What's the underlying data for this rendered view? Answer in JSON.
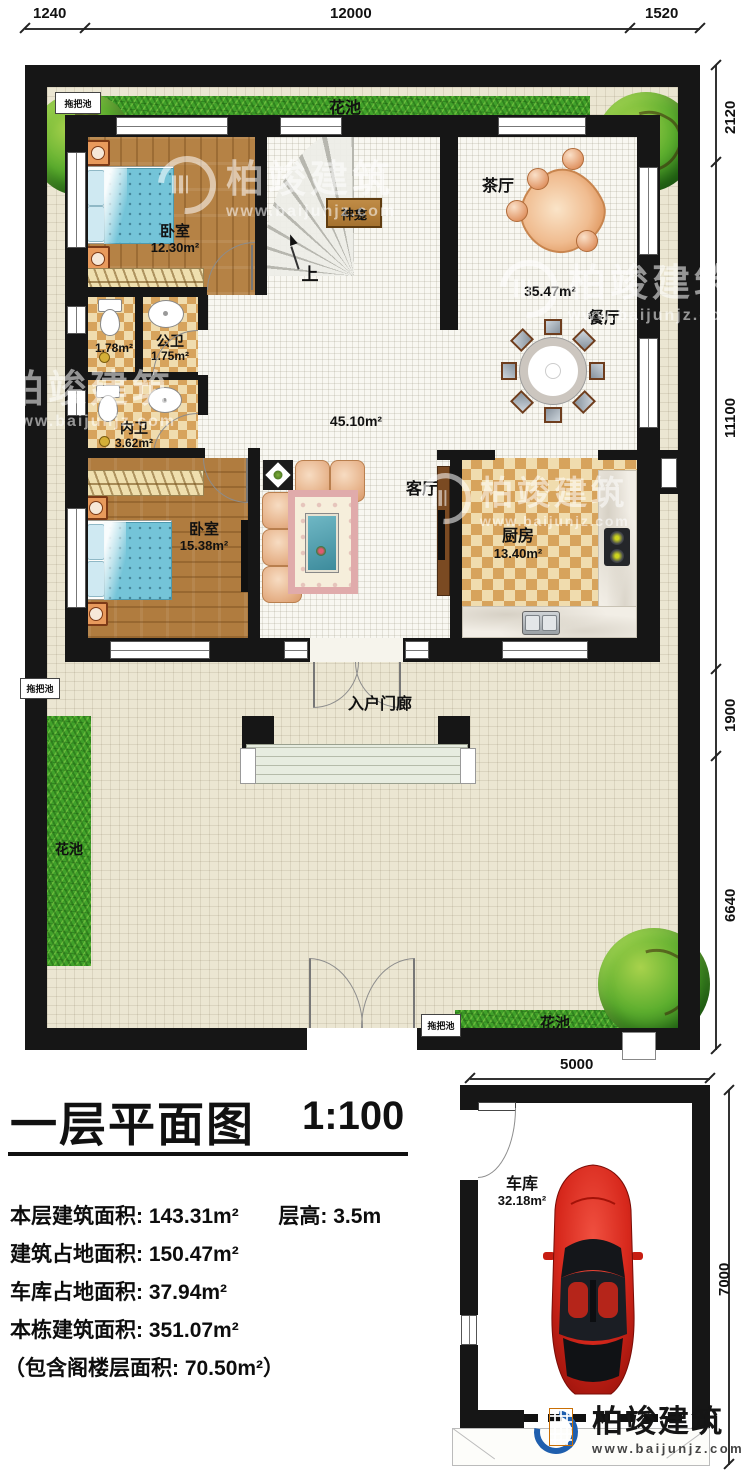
{
  "dimensions": {
    "top": {
      "d1": "1240",
      "d2": "12000",
      "d3": "1520"
    },
    "right": {
      "d1": "2120",
      "d2": "11100",
      "d3": "1900",
      "d4": "6640"
    },
    "garage": {
      "width": "5000",
      "height": "7000"
    }
  },
  "site": {
    "flower_bed": "花池",
    "mop_pool": "拖把池"
  },
  "house": {
    "bedroom1": {
      "name": "卧室",
      "area": "12.30m²"
    },
    "bedroom2": {
      "name": "卧室",
      "area": "15.38m²"
    },
    "public_bath": {
      "name": "公卫",
      "area": "1.75m²",
      "annex_area": "1.78m²"
    },
    "ensuite": {
      "name": "内卫",
      "area": "3.62m²"
    },
    "tea_room": {
      "name": "茶厅"
    },
    "dining": {
      "name": "餐厅",
      "area": "35.47m²"
    },
    "living": {
      "name": "客厅",
      "area": "45.10m²"
    },
    "kitchen": {
      "name": "厨房",
      "area": "13.40m²"
    },
    "shrine": "神龛",
    "stairs_up": "上",
    "porch": "入户门廊"
  },
  "garage": {
    "name": "车库",
    "area": "32.18m²"
  },
  "titleblock": {
    "title": "一层平面图",
    "scale": "1:100",
    "stats": {
      "floor_area": "本层建筑面积: 143.31m²",
      "story_height": "层高: 3.5m",
      "footprint": "建筑占地面积: 150.47m²",
      "garage_footprint": "车库占地面积: 37.94m²",
      "total_area": "本栋建筑面积: 351.07m²",
      "attic_note": "（包含阁楼层面积: 70.50m²）"
    }
  },
  "brand": {
    "name": "柏竣建筑",
    "url": "www.baijunjz.com"
  },
  "colors": {
    "wall": "#161616",
    "grass": "#41a12a",
    "wood": "#b07c3f",
    "tile_warm": "#d7a35c",
    "car_red": "#d7281c",
    "water_blue": "#74c4d8"
  }
}
